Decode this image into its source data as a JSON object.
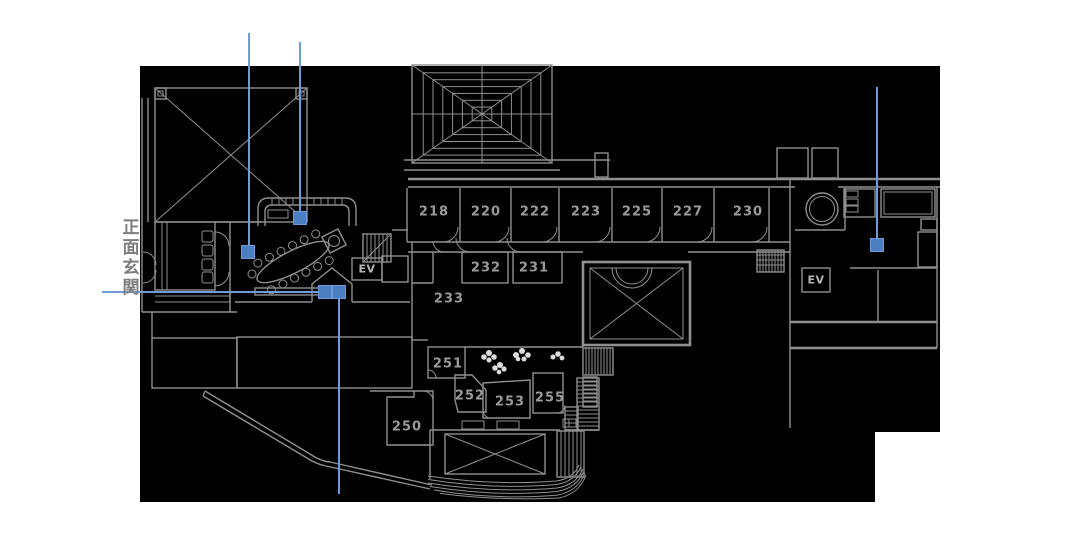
{
  "theme": {
    "page_bg": "#ffffff",
    "plan_bg": "#000000",
    "wall": "#8f8f8f",
    "label": "#9a9a9a",
    "ev": "#b5b5b5",
    "entrance_text": "#7d7d7d",
    "marker": "#4a80c2",
    "leader": "#6f9bd6",
    "flower": "#dcdcdc"
  },
  "entrance_label": {
    "text": "正面玄関"
  },
  "rooms": [
    {
      "label": "218"
    },
    {
      "label": "220"
    },
    {
      "label": "222"
    },
    {
      "label": "223"
    },
    {
      "label": "225"
    },
    {
      "label": "227"
    },
    {
      "label": "230"
    },
    {
      "label": "232"
    },
    {
      "label": "231"
    },
    {
      "label": "233"
    },
    {
      "label": "251"
    },
    {
      "label": "252"
    },
    {
      "label": "253"
    },
    {
      "label": "255"
    },
    {
      "label": "250"
    }
  ],
  "elevators": [
    {
      "label": "EV"
    },
    {
      "label": "EV"
    }
  ],
  "markers": {
    "count": 5,
    "shape": "square"
  }
}
